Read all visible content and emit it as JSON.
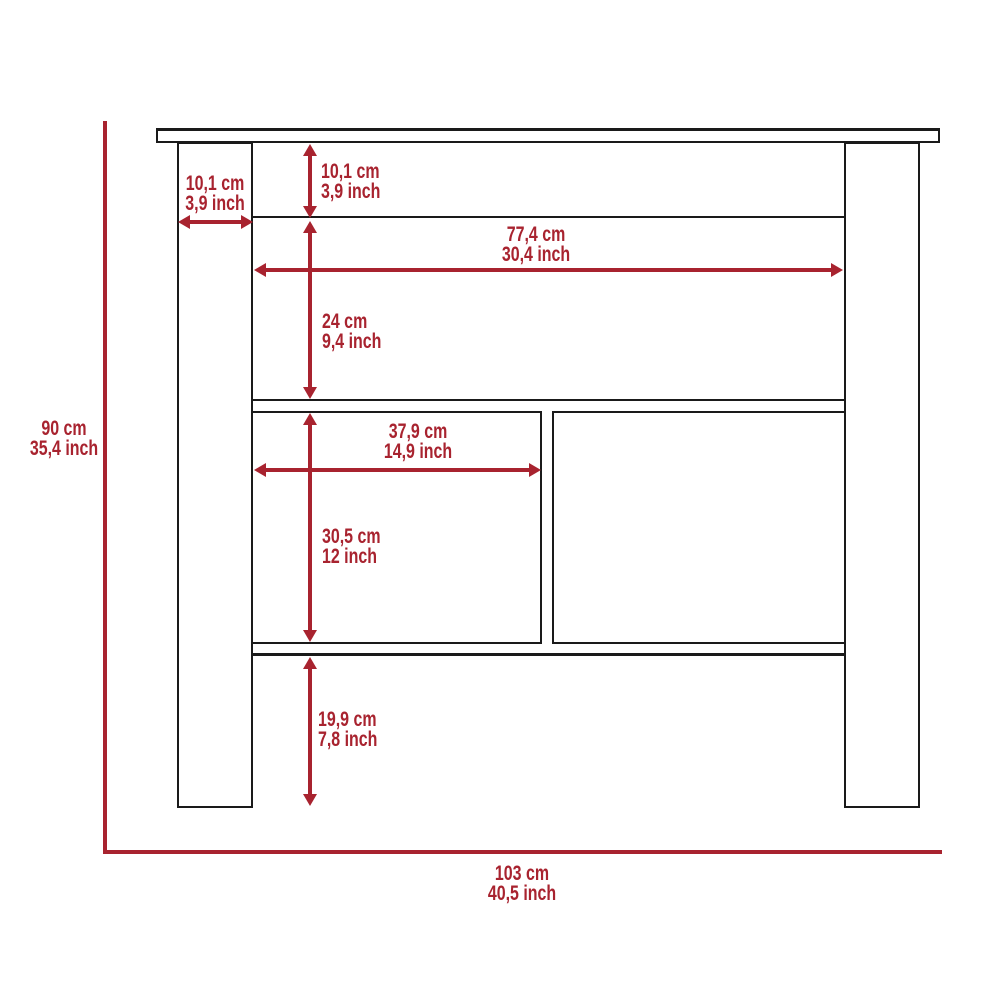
{
  "title": "Kitchen island dimension diagram",
  "colors": {
    "dimension_red": "#A8232F",
    "outline_black": "#1a1a1a",
    "background": "#ffffff"
  },
  "dimensions": {
    "overall_height": {
      "cm": "90 cm",
      "inch": "35,4 inch"
    },
    "overall_width": {
      "cm": "103 cm",
      "inch": "40,5 inch"
    },
    "leg_width": {
      "cm": "10,1 cm",
      "inch": "3,9 inch"
    },
    "top_section_height": {
      "cm": "10,1 cm",
      "inch": "3,9 inch"
    },
    "inner_width": {
      "cm": "77,4 cm",
      "inch": "30,4 inch"
    },
    "upper_shelf_height": {
      "cm": "24 cm",
      "inch": "9,4 inch"
    },
    "left_compartment_width": {
      "cm": "37,9 cm",
      "inch": "14,9 inch"
    },
    "lower_section_height": {
      "cm": "30,5 cm",
      "inch": "12 inch"
    },
    "leg_clearance_height": {
      "cm": "19,9 cm",
      "inch": "7,8 inch"
    }
  }
}
